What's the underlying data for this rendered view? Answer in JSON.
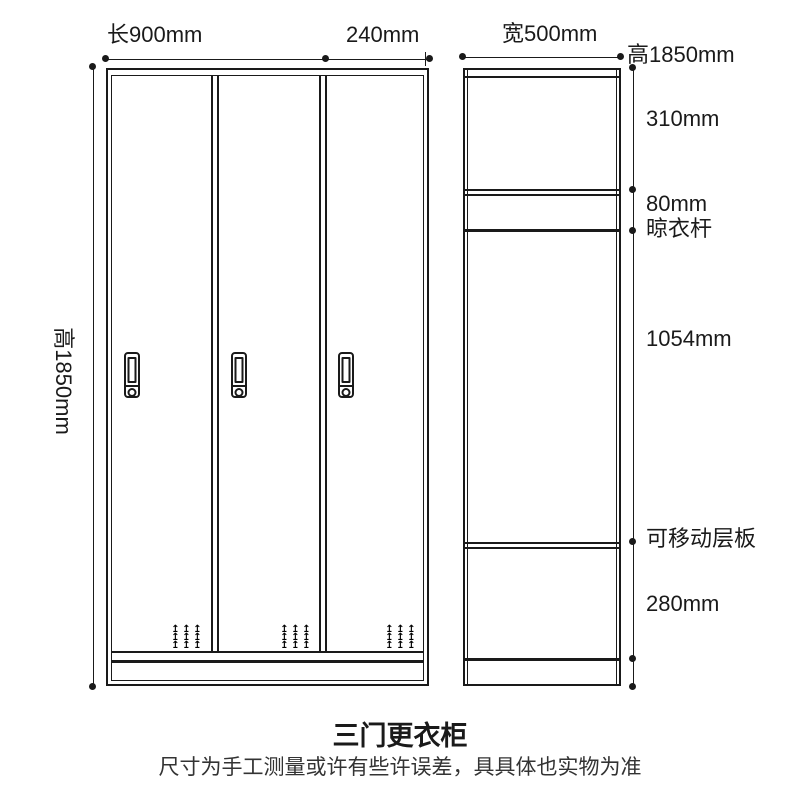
{
  "title": "三门更衣柜",
  "subtitle": "尺寸为手工测量或许有些许误差，具具体也实物为准",
  "colors": {
    "line": "#1a1a1a",
    "text": "#1a1a1a",
    "subtitle_text": "#333333",
    "background": "#ffffff"
  },
  "front_view": {
    "dim_top_length": "长900mm",
    "dim_top_door": "240mm",
    "dim_left_height": "高1850mm"
  },
  "side_view": {
    "dim_top_width": "宽500mm",
    "dim_right_height": "高1850mm",
    "right_annotations": [
      "310mm",
      "80mm",
      "晾衣杆",
      "1054mm",
      "可移动层板",
      "280mm"
    ]
  },
  "icons": {
    "vent_arrow": "↥"
  }
}
